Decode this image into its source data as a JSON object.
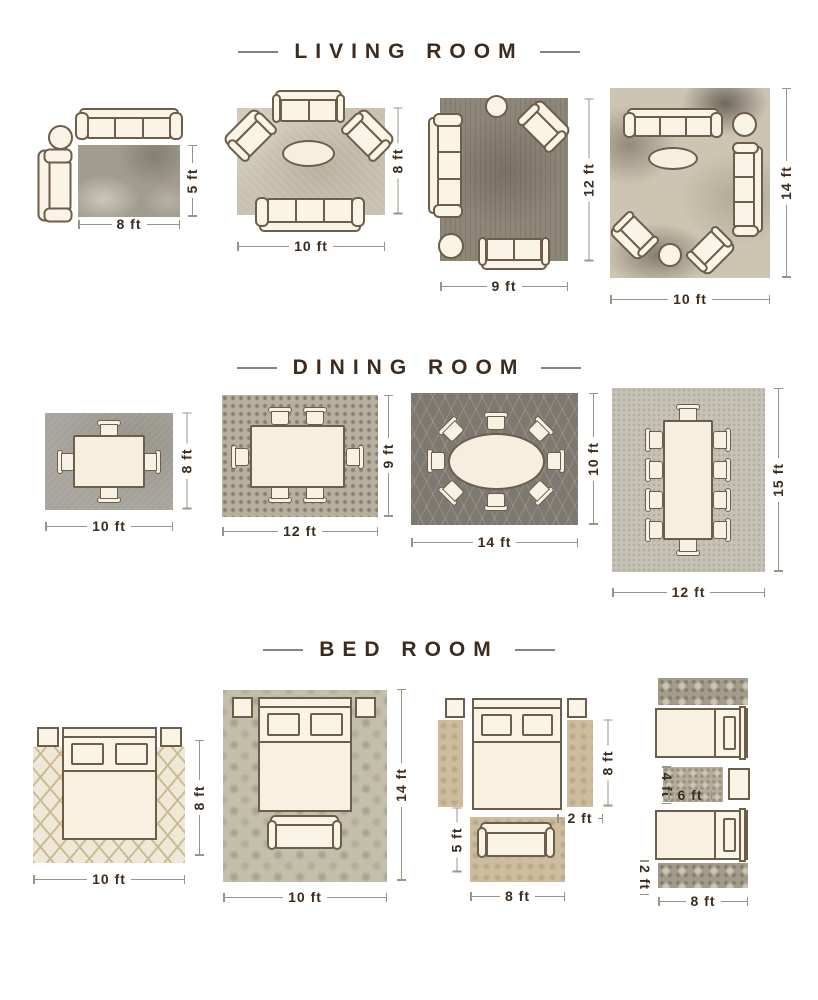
{
  "accent_color": "#3d2b1d",
  "sections": {
    "living": {
      "title": "LIVING ROOM",
      "layouts": {
        "l1": {
          "width": "8 ft",
          "height": "5 ft"
        },
        "l2": {
          "width": "10 ft",
          "height": "8 ft"
        },
        "l3": {
          "width": "9 ft",
          "height": "12 ft"
        },
        "l4": {
          "width": "10 ft",
          "height": "14 ft"
        }
      }
    },
    "dining": {
      "title": "DINING ROOM",
      "layouts": {
        "d1": {
          "width": "10 ft",
          "height": "8 ft"
        },
        "d2": {
          "width": "12 ft",
          "height": "9 ft"
        },
        "d3": {
          "width": "14 ft",
          "height": "10 ft"
        },
        "d4": {
          "width": "12 ft",
          "height": "15 ft"
        }
      }
    },
    "bed": {
      "title": "BED ROOM",
      "layouts": {
        "b1": {
          "width": "10 ft",
          "height": "8 ft"
        },
        "b2": {
          "width": "10 ft",
          "height": "14 ft"
        },
        "b3": {
          "runner_height": "8 ft",
          "runner_width": "2 ft",
          "accent_rug_height": "5 ft",
          "accent_rug_width": "8 ft"
        },
        "b4": {
          "small_rug_height": "4 ft",
          "small_rug_width": "6 ft",
          "runner_width": "2 ft",
          "runner_length": "8 ft"
        }
      }
    }
  }
}
